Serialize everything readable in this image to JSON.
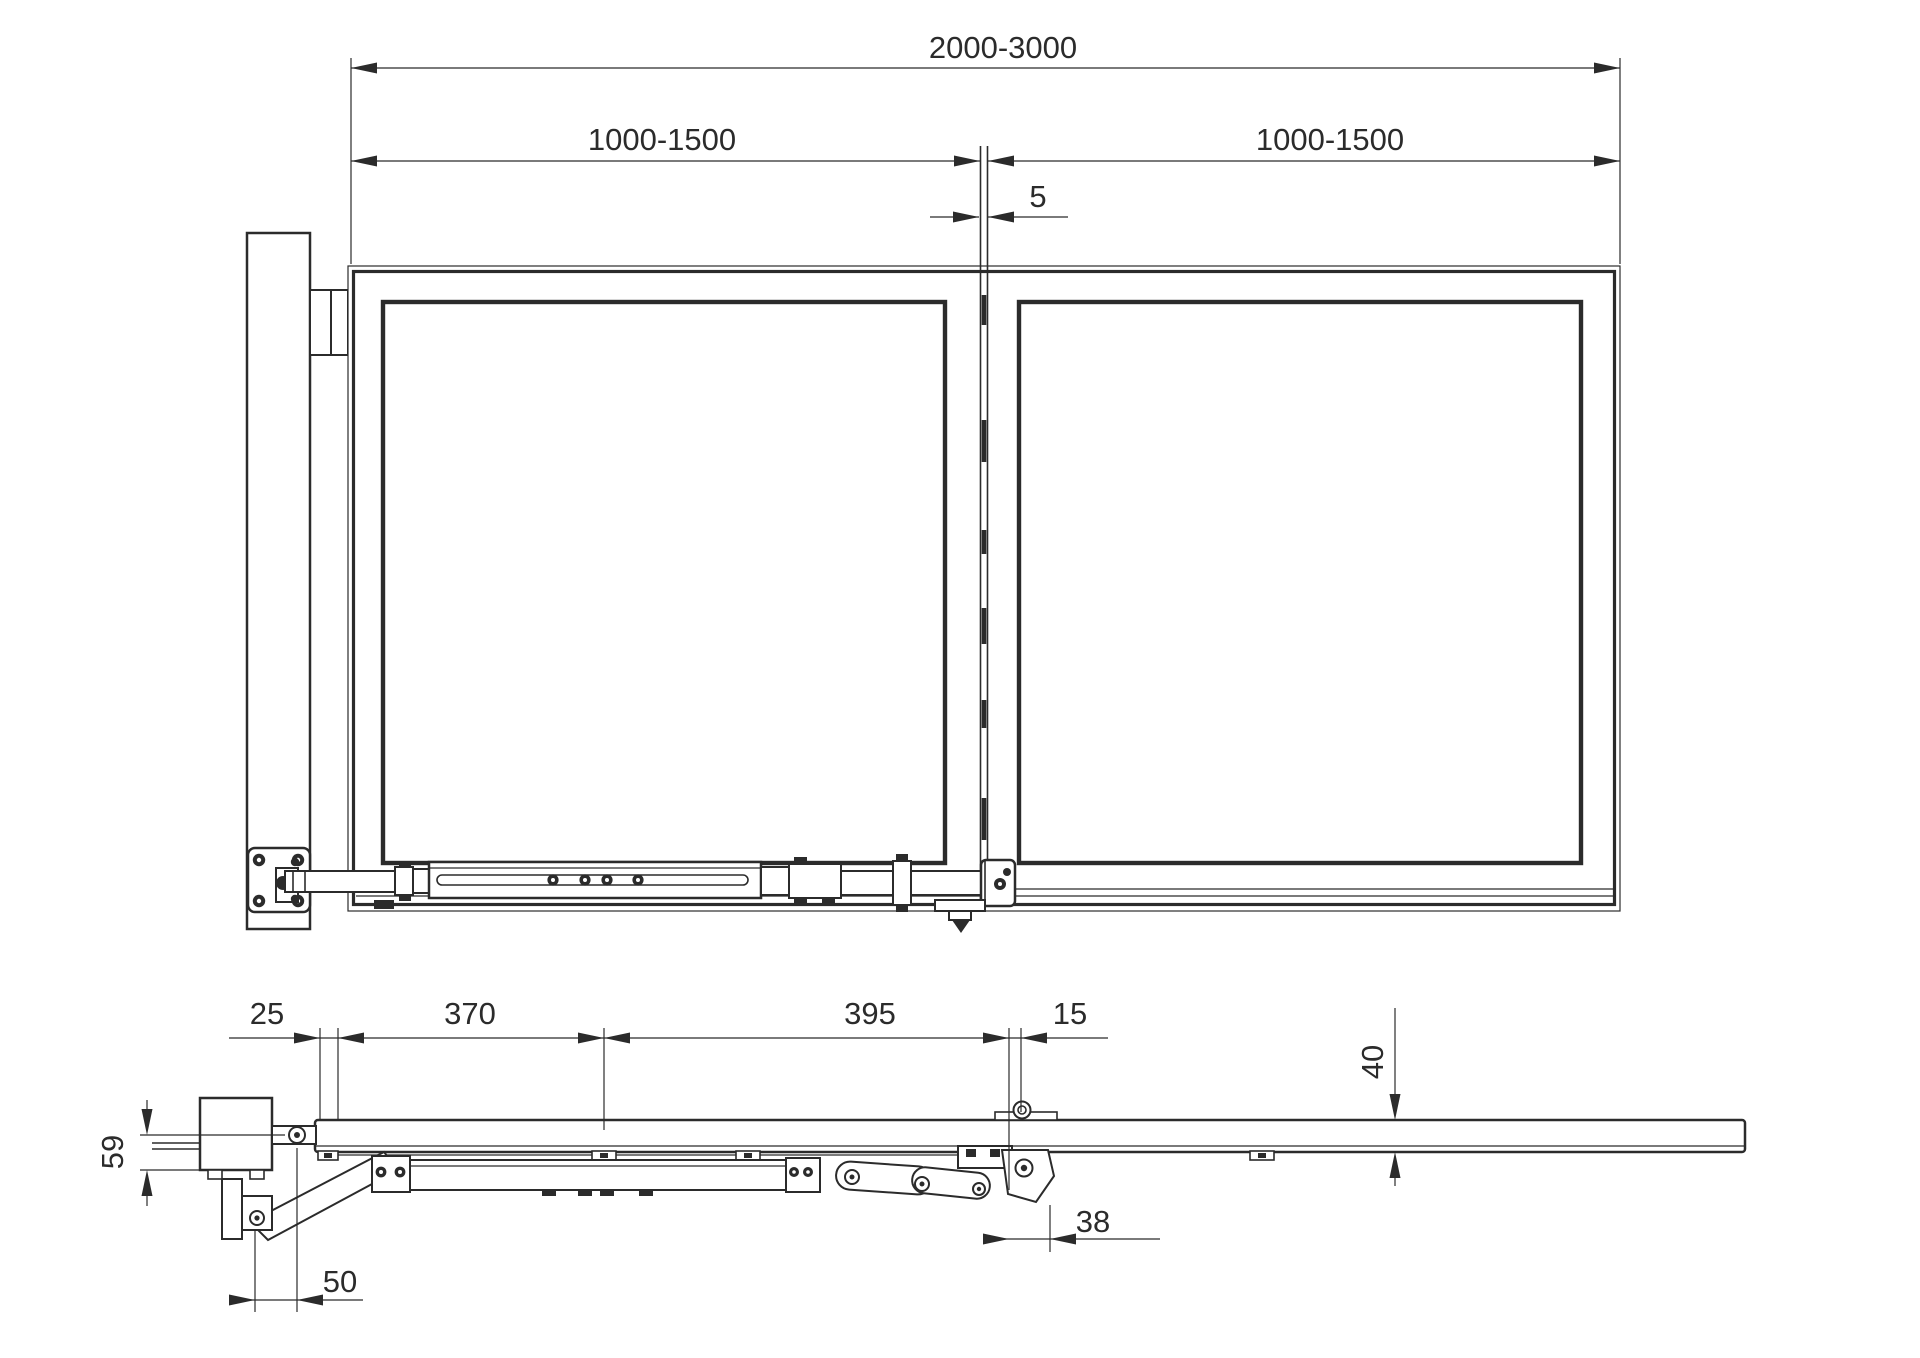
{
  "top_view": {
    "dim_total_width": "2000-3000",
    "dim_left_leaf_width": "1000-1500",
    "dim_right_leaf_width": "1000-1500",
    "dim_leaf_gap": "5"
  },
  "side_view": {
    "dim_wall_offset": "25",
    "dim_actuator_front_span": "370",
    "dim_actuator_rear_span": "395",
    "dim_hinge_offset": "15",
    "dim_rail_height": "40",
    "dim_motor_height": "59",
    "dim_hinge_bracket_width": "38",
    "dim_pivot_spacing": "50"
  },
  "colors": {
    "line": "#2b2b2b",
    "background": "#ffffff"
  }
}
